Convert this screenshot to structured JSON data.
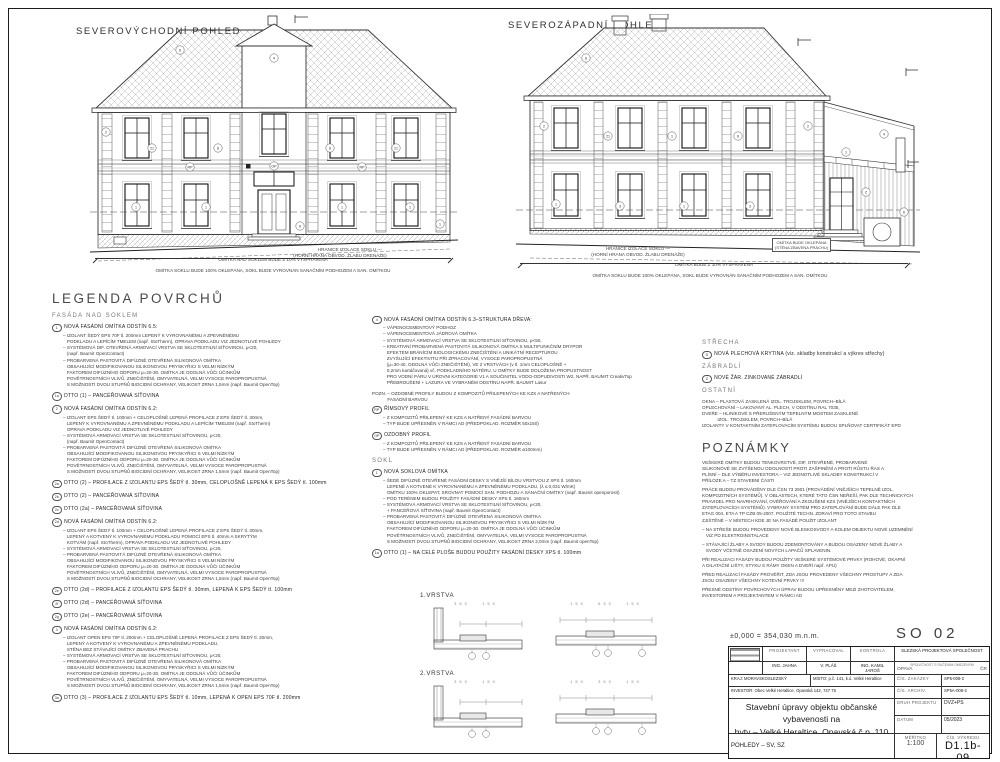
{
  "page": {
    "so": "SO 02",
    "level_note": "±0,000 = 354,030 m.n.m."
  },
  "views": [
    {
      "title": "SEVEROVÝCHODNÍ POHLED",
      "boundary_note1": "HRANICE IZOLACE SOKLU —",
      "boundary_note2": "(HORNÍ HRANA OBVOD. ŽLABU DRENÁŽE)",
      "dim_note_top": "OMÍTKA NAD SOKLEM BUDE Z 10% VYSPRAVENA",
      "dim_note_bottom": "OMÍTKA SOKLU BUDE 100% OKLEPÁNA, SOKL BUDE VYROVNÁN SANAČNÍM PODHOZEM A SAN. OMÍTKOU",
      "callouts": [
        {
          "x": 90,
          "y": 36,
          "t": "S"
        },
        {
          "x": 184,
          "y": 44,
          "t": "4"
        },
        {
          "x": 16,
          "y": 118,
          "t": "2"
        },
        {
          "x": 62,
          "y": 134,
          "t": "21"
        },
        {
          "x": 128,
          "y": 134,
          "t": "8"
        },
        {
          "x": 240,
          "y": 134,
          "t": "8"
        },
        {
          "x": 306,
          "y": 134,
          "t": "21"
        },
        {
          "x": 100,
          "y": 153,
          "t": "RP"
        },
        {
          "x": 272,
          "y": 153,
          "t": "RP"
        },
        {
          "x": 46,
          "y": 193,
          "t": "1"
        },
        {
          "x": 116,
          "y": 193,
          "t": "1"
        },
        {
          "x": 252,
          "y": 193,
          "t": "1"
        },
        {
          "x": 320,
          "y": 193,
          "t": "1"
        },
        {
          "x": 184,
          "y": 152,
          "t": "OP"
        },
        {
          "x": 210,
          "y": 212,
          "t": "6"
        },
        {
          "x": 350,
          "y": 210,
          "t": "1"
        }
      ]
    },
    {
      "title": "SEVEROZÁPADNÍ POHLED",
      "boundary_note1": "HRANICE IZOLACE SOKLU —",
      "boundary_note2": "(HORNÍ HRANA OBVOD. ŽLABU DRENÁŽE)",
      "box_note": "OMÍTKA BUDE OKLEPÁNA\n(STĚNA ZBAVENA PRACHU)",
      "dim_note_top": "OMÍTKA BUDE Z 10% VYSPRAVENA",
      "dim_note_bottom": "OMÍTKA SOKLU BUDE 100% OKLEPÁNA, SOKL BUDE VYROVNÁN SANAČNÍM PODHOZEM A SAN. OMÍTKOU",
      "callouts": [
        {
          "x": 70,
          "y": 44,
          "t": "S"
        },
        {
          "x": 28,
          "y": 112,
          "t": "2"
        },
        {
          "x": 92,
          "y": 122,
          "t": "21"
        },
        {
          "x": 156,
          "y": 122,
          "t": "1"
        },
        {
          "x": 222,
          "y": 122,
          "t": "8"
        },
        {
          "x": 292,
          "y": 112,
          "t": "2"
        },
        {
          "x": 40,
          "y": 190,
          "t": "1"
        },
        {
          "x": 104,
          "y": 192,
          "t": "3"
        },
        {
          "x": 168,
          "y": 192,
          "t": "1"
        },
        {
          "x": 234,
          "y": 192,
          "t": "3"
        },
        {
          "x": 330,
          "y": 138,
          "t": "1"
        },
        {
          "x": 350,
          "y": 178,
          "t": "Z"
        },
        {
          "x": 368,
          "y": 120,
          "t": "4"
        },
        {
          "x": 388,
          "y": 198,
          "t": "6"
        }
      ]
    }
  ],
  "legend": {
    "title": "LEGENDA POVRCHŮ",
    "col1": [
      {
        "k": "head",
        "text": "FASÁDA NAD SOKLEM"
      },
      {
        "k": "item",
        "num": "1",
        "label": "NOVÁ FASÁDNÍ OMÍTKA ODSTÍN 6.5:",
        "body": "– IZOLANT ŠEDÝ EPS 70F tl. 200mm LEPENÝ K VYROVNANÉMU A ZPEVNĚNÉMU\n   PODKLADU A LEPÍCÍM TMELEM (např. StoTherm), OPRAVA PODKLADU VIZ JEDNOTLIVÉ POHLEDY\n– SYSTÉMOVÁ DIF. OTEVŘENÁ ARMOVACÍ VRSTVA SE SKLOTEXTILNÍ SÍŤOVINOU, μ<20,\n   (např. Baumit OpenContact)\n– PROBARVENÁ PASTOVITÁ DIFÚZNĚ OTEVŘENÁ SILIKONOVÁ OMÍTKA\n   OBSAHUJÍCÍ MODIFIKOVANOU SILIKONOVOU PRYSKYŘICI S VELMI NÍZKÝM\n   FAKTOREM DIFÚZNÍHO ODPORU μ=20-30. OMÍTKA JE ODOLNÁ VŮČI ÚČINKŮM\n   POVĚTRNOSTNÍCH VLIVŮ, ZNEČIŠTĚNÍ, OMYVATELNÁ, VELMI VYSOCE PAROPROPUSTNÁ\n   S MOŽNOSTÍ DVOU STUPŇŮ BIOCIDNÍ OCHRANY, VELIKOST ZRNA 1,5mm (např. Baumit OpenTop)"
      },
      {
        "k": "item",
        "num": "1a",
        "label": "DTTO (1) – PANCÉŘOVANÁ SÍŤOVINA",
        "body": ""
      },
      {
        "k": "item",
        "num": "2",
        "label": "NOVÁ FASÁDNÍ OMÍTKA ODSTÍN 6.2:",
        "body": "– IZOLANT EPS ŠEDÝ tl. 100mm + CELOPLOŠNĚ LEPENÁ PROFILACE Z EPS ŠEDÝ tl. 30mm,\n   LEPENÝ K VYROVNANÉMU A ZPEVNĚNÉMU PODKLADU A LEPÍCÍM TMELEM (např. StoTherm)\n   OPRAVA PODKLADU VIZ JEDNOTLIVÉ POHLEDY\n– SYSTÉMOVÁ ARMOVACÍ VRSTVA SE SKLOTEXTILNÍ SÍŤOVINOU, μ<20,\n   (např. Baumit OpenContact)\n– PROBARVENÁ PASTOVITÁ DIFÚZNĚ OTEVŘENÁ SILIKONOVÁ OMÍTKA\n   OBSAHUJÍCÍ MODIFIKOVANOU SILIKONOVOU PRYSKYŘICI S VELMI NÍZKÝM\n   FAKTOREM DIFÚZNÍHO ODPORU μ=20-30. OMÍTKA JE ODOLNÁ VŮČI ÚČINKŮM\n   POVĚTRNOSTNÍCH VLIVŮ, ZNEČIŠTĚNÍ, OMYVATELNÁ, VELMI VYSOCE PAROPROPUSTNÁ\n   S MOŽNOSTÍ DVOU STUPŇŮ BIOCIDNÍ OCHRANY, VELIKOST ZRNA 1,5mm (např. Baumit OpenTop)"
      },
      {
        "k": "item",
        "num": "2a",
        "label": "DTTO (2) – PROFILACE Z IZOLANTU EPS ŠEDÝ tl. 30mm, CELOPLOŠNĚ LEPENÁ K EPS ŠEDÝ tl. 100mm",
        "body": ""
      },
      {
        "k": "item",
        "num": "2b",
        "label": "DTTO (2) – PANCÉŘOVANÁ SÍŤOVINA",
        "body": ""
      },
      {
        "k": "item",
        "num": "2c",
        "label": "DTTO (2a) – PANCÉŘOVANÁ SÍŤOVINA",
        "body": ""
      },
      {
        "k": "item",
        "num": "2d",
        "label": "NOVÁ FASÁDNÍ OMÍTKA ODSTÍN 6.2:",
        "body": "– IZOLANT EPS ŠEDÝ tl. 100mm + CELOPLOŠNĚ LEPENÁ PROFILACE Z EPS ŠEDÝ tl. 30mm,\n   LEPENÝ A KOTVENÝ K VYROVNANÉMU PODKLADU POMOCÍ EPS tl. 40mm A SKRYTÝM\n   KOTVÁM (např. StoTherm), OPRAVA PODKLADU VIZ JEDNOTLIVÉ POHLEDY\n– SYSTÉMOVÁ ARMOVACÍ VRSTVA SE SKLOTEXTILNÍ SÍŤOVINOU, μ<20,\n– PROBARVENÁ PASTOVITÁ DIFÚZNĚ OTEVŘENÁ SILIKONOVÁ OMÍTKA\n   OBSAHUJÍCÍ MODIFIKOVANOU SILIKONOVOU PRYSKYŘICI S VELMI NÍZKÝM\n   FAKTOREM DIFÚZNÍHO ODPORU μ=20-30. OMÍTKA JE ODOLNÁ VŮČI ÚČINKŮM\n   POVĚTRNOSTNÍCH VLIVŮ, ZNEČIŠTĚNÍ, OMYVATELNÁ, VELMI VYSOCE PAROPROPUSTNÁ\n   S MOŽNOSTÍ DVOU STUPŇŮ BIOCIDNÍ OCHRANY, VELIKOST ZRNA 1,5mm (např. Baumit OpenTop)"
      },
      {
        "k": "item",
        "num": "2e",
        "label": "DTTO (2d) – PROFILACE Z IZOLANTU EPS ŠEDÝ tl. 30mm, LEPENÁ K EPS ŠEDÝ tl. 100mm",
        "body": ""
      },
      {
        "k": "item",
        "num": "2f",
        "label": "DTTO (2d) – PANCÉŘOVANÁ SÍŤOVINA",
        "body": ""
      },
      {
        "k": "item",
        "num": "2g",
        "label": "DTTO (2e) – PANCÉŘOVANÁ SÍŤOVINA",
        "body": ""
      },
      {
        "k": "item",
        "num": "3",
        "label": "NOVÁ FASÁDNÍ OMÍTKA ODSTÍN 6.2:",
        "body": "– IZOLANT OPEN EPS 70F tl. 200mm + CELOPLOŠNĚ LEPENÁ PROFILACE Z EPS ŠEDÝ tl. 20mm,\n   LEPENÝ A KOTVENÝ K VYROVNANÉMU A ZPEVNĚNÉMU PODKLADU,\n   STĚNA BEZ STÁVAJÍCÍ OMÍTKY ZBAVENÁ PRACHU\n– SYSTÉMOVÁ ARMOVACÍ VRSTVA SE SKLOTEXTILNÍ SÍŤOVINOU, μ<20,\n– PROBARVENÁ PASTOVITÁ DIFÚZNĚ OTEVŘENÁ SILIKONOVÁ OMÍTKA\n   OBSAHUJÍCÍ MODIFIKOVANOU SILIKONOVOU PRYSKYŘICI S VELMI NÍZKÝM\n   FAKTOREM DIFÚZNÍHO ODPORU μ=20-30. OMÍTKA JE ODOLNÁ VŮČI ÚČINKŮM\n   POVĚTRNOSTNÍCH VLIVŮ, ZNEČIŠTĚNÍ, OMYVATELNÁ, VELMI VYSOCE PAROPROPUSTNÁ\n   S MOŽNOSTÍ DVOU STUPŇŮ BIOCIDNÍ OCHRANY, VELIKOST ZRNA 1,5mm (např. Baumit OpenTop)"
      },
      {
        "k": "item",
        "num": "3a",
        "label": "DTTO (3) – PROFILACE Z IZOLANTU EPS ŠEDÝ tl. 10mm, LEPENÁ K OPEN EPS 70F tl. 200mm",
        "body": ""
      }
    ],
    "col2": [
      {
        "k": "item",
        "num": "4",
        "label": "NOVÁ FASÁDNÍ OMÍTKA ODSTÍN 6.3–STRUKTURA DŘEVA:",
        "body": "– VÁPENOCEMENTOVÝ PODHOZ\n– VÁPENOCEMENTOVÁ JÁDROVÁ OMÍTKA\n– SYSTÉMOVÁ ARMOVACÍ VRSTVA SE SKLOTEXTILNÍ SÍŤOVINOU, μ<50,\n– KREATIVNÍ PROBARVENÁ PASTOVITÁ SILIKONOVÁ OMÍTKA S MULTIFUNKČNÍM DRYPOR\n   EFEKTEM BRÁNÍCÍM BIOLOGICKÉMU ZNEČIŠTĚNÍ A UNIKÁTNÍ RECEPTUROU\n   ZVYŠUJÍCÍ EFEKTIVITU PŘI ZPRACOVÁNÍ, VYSOCE PAROPROPUSTNÁ\n   (μ=30-40, ODOLNÁ VŮČI ZNEČIŠTĚNÍ), VE 2 VRSTVÁCH (v tl. 1mm CELOPLOŠNĚ +\n   0,2mm kartáčovaná) vč. PODKLADNÍHO NÁTĚRU. U OMÍTKY BUDE DOLOŽENA PROPUSTNOST\n   PRO VODNÍ PÁRU V ÚROVNI KATEGORIE V1 A SOUČINITEL VODO-ODPUDIVOSTI W2, NAPŘ. BAUMIT CreativTop\n   PŘEBROUŠENÍ + LAZURA VE VYBRANÉM ODSTÍNU NAPŘ. BAUMIT Lasur"
      },
      {
        "k": "text",
        "body": "POZN. – OZDOBNÉ PROFILY BUDOU Z KOMPOZITŮ PŘILEPENÝCH KE KZS A NATŘENÝCH\n            FASÁDNÍ BARVOU"
      },
      {
        "k": "item",
        "num": "RP",
        "label": "ŘÍMSOVÝ PROFIL",
        "body": "– Z KOMPOZITŮ PŘILEPENÝ KE KZS A NATŘENÝ FASÁDNÍ BARVOU\n– TYP BUDE UPŘESNĚN V RÁMCI AD (PŘEDPOKLAD. ROZMĚR 50x150)"
      },
      {
        "k": "item",
        "num": "OP",
        "label": "OZDOBNÝ PROFIL",
        "body": "– Z KOMPOZITŮ PŘILEPENÝ KE KZS A NATŘENÝ FASÁDNÍ BARVOU\n– TYP BUDE UPŘESNĚN V RÁMCI AD (PŘEDPOKLAD. ROZMĚR ø100mm)"
      },
      {
        "k": "head",
        "text": "SOKL"
      },
      {
        "k": "item",
        "num": "1",
        "label": "NOVÁ SOKLOVÁ OMÍTKA",
        "body": "– ŠEDÉ DIFÚZNĚ OTEVŘENÉ FASÁDNÍ DESKY S VNĚJŠÍ BÍLOU VRSTVOU Z XPS tl. 160mm\n   LEPENÉ A KOTVENÉ K VYROVNANÉMU A ZPEVNĚNÉMU PODKLADU, (λ ≤ 0,031 W/mK)\n   OMÍTKU 100% OKLEPAT, SROVNAT POMOCÍ SAN. PODHOZU A SANAČNÍ OMÍTKY (např. Baumit openporosit)\n– POD TERÉNEM BUDOU POUŽITY FASÁDNÍ DESKY XPS tl. 160mm\n– SYSTÉMOVÁ ARMOVACÍ VRSTVA SE SKLOTEXTILNÍ SÍŤOVINOU, μ<20,\n   + PANCÉŘOVÁ SÍŤOVINA (např. Baumit OpenContact)\n– PROBARVENÁ PASTOVITÁ DIFÚZNĚ OTEVŘENÁ SILIKONOVÁ OMÍTKA\n   OBSAHUJÍCÍ MODIFIKOVANOU SILIKONOVOU PRYSKYŘICI S VELMI NÍZKÝM\n   FAKTOREM DIFÚZNÍHO ODPORU μ=20-30. OMÍTKA JE ODOLNÁ VŮČI ÚČINKŮM\n   POVĚTRNOSTNÍCH VLIVŮ, ZNEČIŠTĚNÍ, OMYVATELNÁ, VELMI VYSOCE PAROPROPUSTNÁ\n   S MOŽNOSTÍ DVOU STUPŇŮ BIOCIDNÍ OCHRANY, VELIKOST ZRNA 2,0mm (např. Baumit openTop)"
      },
      {
        "k": "item",
        "num": "1a",
        "label": "DTTO (1) – NA CELÉ PLOŠE BUDOU POUŽITY FASÁDNÍ DESKY XPS tl. 100mm",
        "body": ""
      }
    ],
    "col3": [
      {
        "k": "head",
        "text": "STŘECHA"
      },
      {
        "k": "item",
        "num": "S",
        "label": "NOVÁ PLECHOVÁ KRYTINA (viz. skladby konstrukcí a výkres střechy)",
        "body": ""
      },
      {
        "k": "head",
        "text": "ZÁBRADLÍ"
      },
      {
        "k": "item",
        "num": "Z",
        "label": "NOVÉ ŽÁR. ZINKOVANÉ ZÁBRADLÍ",
        "body": ""
      },
      {
        "k": "head",
        "text": "OSTATNÍ"
      },
      {
        "k": "text",
        "body": "OKNA – PLASTOVÁ ZASKLENÁ IZOL. TROJSKLEM, POVRCH–BÍLÁ\nOPLECHOVÁNÍ – LAKOVANÝ AL. PLECH, V ODSTÍNU RAL 7035,\nDVEŘE – HLINÍKOVÉ S PŘERUŠENÝM TEPELNÝM MOSTEM ZASKLENÉ\n            IZOL. TROJSKLEM, POVRCH–BÍLÁ\nIZOLANTY V KONTAKTNÍM ZATEPLOVACÍM SYSTÉMU BUDOU SPLŇOVAT CERTIFIKÁT EPD"
      },
      {
        "k": "big",
        "text": "POZNÁMKY"
      },
      {
        "k": "text",
        "body": "VEŠKERÉ OMÍTKY BUDOU TENKOVRSTVÉ, DIF. OTEVŘENÉ, PROBARVENÉ\nSILIKONOVÉ SE ZVÝŠENOU ODOLNOSTÍ PROTI ZAŠPINĚNÍ A PROTI RŮSTU ŘAS A\nPLÍSNÍ – DLE VÝBĚRU INVESTORA – VIZ JEDNOTLIVÉ SKLADBY KONSTRUKCÍ V\nPŘÍLOZE A – TZ STAVEBNÍ ČÁSTI"
      },
      {
        "k": "text",
        "body": "PRÁCE BUDOU PROVÁDĚNY DLE ČSN 73 2901 (PROVÁDĚNÍ VNĚJŠÍCH TEPELNĚ IZOL.\nKOMPOZITNÍCH SYSTÉMŮ). V OBLASTECH, KTERÉ TATO ČSN NEŘEŠÍ, PAK DLE TECHNICKÝCH\nPRAVIDEL PRO NAVRHOVÁNÍ, OVĚŘOVÁNÍ A ZKOUŠENÍ KZS (VNĚJŠÍCH KONTAKTNÍCH\nZATEPLOVACÍCH SYSTÉMŮ). VYBRANÝ SYSTÉM PRO ZATEPLOVÁNÍ BUDE DÁLE PAK DLE\nETAG 004, ETA A TP CZB 05-2007. POUŽITÉ TECHN. ZDRAVÍ PRO TOTO STAVBU\nZJIŠTĚNÉ – V MÍSTECH KDE JE NA FASÁDĚ POUŽIT IZOLANT"
      },
      {
        "k": "text",
        "body": "– NA STŘEŠE BUDOU PROVEDENY NOVÉ BLESKOSVODY A KOLEM OBJEKTU NOVÉ UZEMNĚNÍ\n   VIZ PD ELEKTROINSTALACE"
      },
      {
        "k": "text",
        "body": "– STÁVAJÍCÍ ŽLABY A SVODY BUDOU ZDEMONTOVÁNY A BUDOU OSAZENY NOVÉ ŽLABY A\n   SVODY VČETNĚ OSAZENÍ NOVÝCH LAPAČŮ SPLAVENIN."
      },
      {
        "k": "text",
        "body": "PŘI REALIZACI FASÁDY BUDOU POUŽITY VEŠKERÉ SYSTÉMOVÉ PRVKY (ROHOVÉ, OKAPNÍ\nA DILATAČNÍ LIŠTY, STYKU S RÁMY OKEN A DVEŘÍ např. APU)"
      },
      {
        "k": "text",
        "body": "PŘED REALIZACÍ FASÁDY PROVĚŘIT, ZDA JSOU PROVEDENY VŠECHNY PROSTUPY A ZDA\nJSOU OSAZENY VŠECHNY KOTEVNÍ PRVKY !!!"
      },
      {
        "k": "text",
        "body": "PŘESNÉ ODSTÍNY POVRCHOVÝCH ÚPRAV BUDOU UPŘESNĚNY MEZI ZHOTOVITELEM,\nINVESTOREM A PROJEKTANTEM V RÁMCI AD"
      }
    ]
  },
  "details": {
    "t1": "1.VRSTVA",
    "t2": "2.VRSTVA",
    "d1a": "350   150",
    "d1b": "150   630   150",
    "d2a": "350   150",
    "d2b": "150   350   150"
  },
  "titleblock": {
    "col_projektant": "PROJEKTANT",
    "col_vypracoval": "VYPRACOVAL",
    "col_kontrola": "KONTROLA",
    "projektant": "ING. JAHNA",
    "vypracoval": "V. PLÁŠ",
    "kontrola": "ING. KAMIL JAROŠ",
    "company1": "SLEZSKÁ PROJEKTOVÁ SPOLEČNOST",
    "company2": "SPOLEČNOST S RUČENÍM OMEZENÝM",
    "company_city": "OPAVA",
    "company_country": "ČR",
    "kraj": "KRAJ: MORAVSKOSLEZSKÝ",
    "misto": "MÍSTO: p.č. 141, k.ú. Velké Heraltice",
    "investor": "INVESTOR: Obec Velké Heraltice, Opavská 142, 747 75",
    "zakazka_l": "ČÍS. ZAKÁZKY",
    "zakazka_v": "SP5-008-2",
    "archiv_l": "ČÍS. ARCHIV.",
    "archiv_v": "SP5A-008-2",
    "druh_l": "DRUH PROJEKTU",
    "druh_v": "DVZ+PS",
    "datum_l": "DATUM",
    "datum_v": "05/2023",
    "title1": "Stavební úpravy objektu občanské vybavenosti na",
    "title2": "byty – Velké Heraltice, Opavská č.p. 110",
    "pohledy": "POHLEDY – SV, SZ",
    "meritko_l": "MĚŘÍTKO",
    "meritko_v": "1:100",
    "cislo_l": "ČÍS. VÝKRESU",
    "cislo_v": "D1.1b-09"
  }
}
